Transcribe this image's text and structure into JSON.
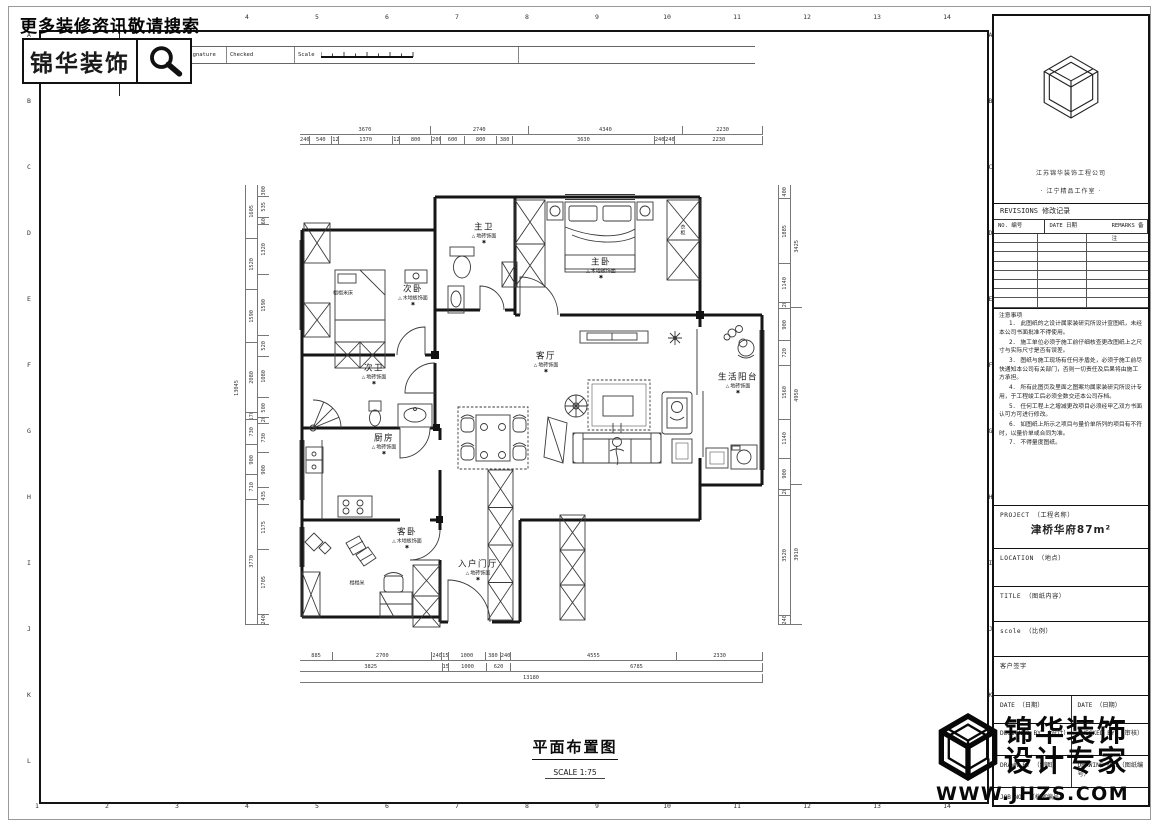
{
  "icons": {
    "level_mark": "△",
    "elevation_mark": "✱"
  },
  "colors": {
    "line": "#141414",
    "paper": "#ffffff",
    "accent": "#000000"
  },
  "header": {
    "search_hint": "更多装修资讯敬请搜索",
    "brand": "锦华装饰",
    "table": {
      "mark": "Mark No.",
      "revision": "Revision",
      "signature": "Signature",
      "checked": "Checked",
      "scale_label": "Scale"
    }
  },
  "grid": {
    "top_numbers": [
      "4",
      "5",
      "6",
      "7",
      "8",
      "9",
      "10",
      "11",
      "12",
      "13",
      "14"
    ],
    "bottom_numbers": [
      "1",
      "2",
      "3",
      "4",
      "5",
      "6",
      "7",
      "8",
      "9",
      "10",
      "11",
      "12",
      "13",
      "14"
    ],
    "left_letters": [
      "A",
      "B",
      "C",
      "D",
      "E",
      "F",
      "G",
      "H",
      "I",
      "J",
      "K",
      "L"
    ],
    "right_letters": [
      "A",
      "B",
      "C",
      "D",
      "E",
      "F",
      "G",
      "H",
      "I",
      "J",
      "K",
      "L"
    ]
  },
  "plan": {
    "title": "平面布置图",
    "scale_text": "SCALE  1:75",
    "rooms": {
      "master_bath": {
        "name": "主卫",
        "finish": "地砖饰面"
      },
      "master_bed": {
        "name": "主卧",
        "finish": "木地板饰面"
      },
      "second_bed": {
        "name": "次卧",
        "finish": "木地板饰面"
      },
      "second_bath": {
        "name": "次卫",
        "finish": "地砖饰面"
      },
      "kitchen": {
        "name": "厨房",
        "finish": "地砖饰面"
      },
      "living": {
        "name": "客厅",
        "finish": "地砖饰面"
      },
      "balcony": {
        "name": "生活阳台",
        "finish": "地砖饰面"
      },
      "guest_bed": {
        "name": "客卧",
        "finish": "木地板饰面"
      },
      "entry": {
        "name": "入户门厅",
        "finish": "地砖饰面"
      }
    },
    "extra_labels": {
      "tatami_bed": "榻榻米床",
      "tatami": "榻榻米",
      "wardrobe": "衣柜"
    }
  },
  "dims": {
    "top1": [
      "3670",
      "2740",
      "4340",
      "2230"
    ],
    "top2": [
      "240",
      "540",
      "120",
      "1370",
      "120",
      "800",
      "200",
      "600",
      "800",
      "380",
      "3630",
      "240",
      "240",
      "2230"
    ],
    "bottom1": [
      "885",
      "2700",
      "240",
      "150",
      "1000",
      "380",
      "240",
      "4555",
      "2330"
    ],
    "bottom2": [
      "3825",
      "150",
      "1000",
      "620",
      "6785"
    ],
    "bottom3": [
      "13180"
    ],
    "left_outer": [
      "1605",
      "1520",
      "1590",
      "2080",
      "170",
      "730",
      "900",
      "710",
      "3770"
    ],
    "left_inner": [
      "300",
      "535",
      "60",
      "1320",
      "1590",
      "520",
      "1080",
      "500",
      "120",
      "730",
      "900",
      "435",
      "1175",
      "1705",
      "240"
    ],
    "left_total": "13045",
    "right_inner": [
      "400",
      "1885",
      "1140",
      "120",
      "900",
      "720",
      "1560",
      "1140",
      "900",
      "120",
      "3520",
      "240"
    ],
    "right_outer": [
      "3425",
      "4950",
      "3910"
    ]
  },
  "titleblock": {
    "company_line1": "江苏锦华装饰工程公司",
    "company_line2": "·  江宁精品工作室  ·",
    "revisions": {
      "title": "REVISIONS 修改记录",
      "columns": [
        "NO. 编号",
        "DATE 日期",
        "REMARKS 备注"
      ],
      "empty_rows": [
        "",
        "",
        "",
        "",
        "",
        "",
        "",
        ""
      ]
    },
    "notes": {
      "title": "注意事项",
      "items": [
        "1． 此图纸的之设计属家装研究所设计宣图纸，未经本公司书面批准不得使用。",
        "2． 施工单位必须于施工前仔细核查更改图纸上之尺寸与实际尺寸是否有误差。",
        "3． 图纸与施工现场有任何矛盾处，必须于施工前尽快通知本公司有关部门，否则一切责任及后果将由施工方承担。",
        "4． 所有此图页及里面之图案均属家装研究所设计专用，于工程竣工后必须全数交还本公司存档。",
        "5． 任何工程上之增减更改项目必须经甲乙双方书面认可方可进行修改。",
        "6． 如图纸上所示之项目与量价单所列的项目有不符时，以量价单或合同为准。",
        "7． 不得量度图纸。"
      ]
    },
    "project_label": "PROJECT （工程名称）",
    "project_value": "津桥华府87m²",
    "location_label": "LOCATION （地点）",
    "title_label": "TITLE （图纸内容）",
    "scale_label": "scole  （比例）",
    "client_sign_label": "客户签字",
    "date_left_label": "DATE （日期）",
    "date_right_label": "DATE （日期）",
    "designed_label": "DESIGNED BY （设计）",
    "checked_label": "CHECKED BY （审核）",
    "drawn_label": "DRAWN BY （制图）",
    "drawing_no_label": "DRAWING NO.（图纸编号）",
    "job_no_label": "JOB NO. （档案编号）"
  },
  "watermark": {
    "line1": "锦华装饰",
    "line2": "设计专家",
    "url": "WWW.JHZS.COM"
  }
}
